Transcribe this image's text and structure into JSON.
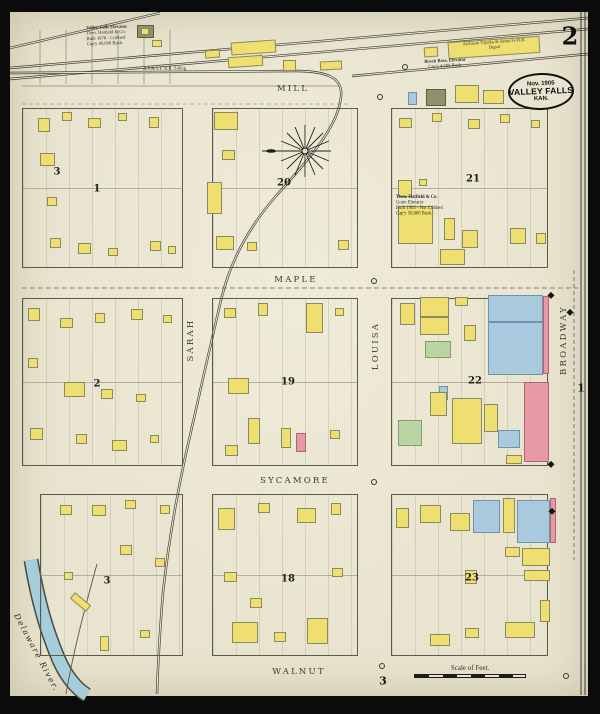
{
  "sheet": {
    "page_number": "2",
    "stamp": {
      "date": "Nov. 1905",
      "city": "VALLEY FALLS",
      "state": "KAN."
    },
    "scale_label": "Scale of Feet."
  },
  "colors": {
    "paper": "#e9e4cf",
    "photo_border": "#0b0b0b",
    "river": "#a5cdda",
    "ink": "#3a3a30",
    "code_map": {
      "f": "frame",
      "b": "brick",
      "s": "stone",
      "g": "special",
      "i": "iron_clad"
    },
    "buildings": {
      "frame": {
        "fill": "#efdf70",
        "stroke": "#8a8a60"
      },
      "brick": {
        "fill": "#e59aa5",
        "stroke": "#b06570"
      },
      "stone": {
        "fill": "#a9cade",
        "stroke": "#6f93ab"
      },
      "special": {
        "fill": "#bad4a4",
        "stroke": "#7fa06b"
      },
      "iron_clad": {
        "fill": "#90906a",
        "stroke": "#5c5c40"
      }
    }
  },
  "streets": [
    {
      "name": "MILL",
      "o": "h",
      "x": 293,
      "y": 89
    },
    {
      "name": "MAPLE",
      "o": "h",
      "x": 296,
      "y": 280
    },
    {
      "name": "SYCAMORE",
      "o": "h",
      "x": 295,
      "y": 481
    },
    {
      "name": "WALNUT",
      "o": "h",
      "x": 299,
      "y": 672
    },
    {
      "name": "SARAH",
      "o": "v",
      "x": 191,
      "y": 340
    },
    {
      "name": "LOUISA",
      "o": "v",
      "x": 376,
      "y": 346
    },
    {
      "name": "BROADWAY",
      "o": "v",
      "x": 564,
      "y": 340
    }
  ],
  "block_labels": [
    {
      "t": "3",
      "x": 57,
      "y": 172
    },
    {
      "t": "1",
      "x": 97,
      "y": 189
    },
    {
      "t": "20",
      "x": 284,
      "y": 183
    },
    {
      "t": "21",
      "x": 473,
      "y": 179
    },
    {
      "t": "2",
      "x": 97,
      "y": 384
    },
    {
      "t": "19",
      "x": 288,
      "y": 382
    },
    {
      "t": "22",
      "x": 475,
      "y": 381
    },
    {
      "t": "3",
      "x": 107,
      "y": 581
    },
    {
      "t": "18",
      "x": 288,
      "y": 579
    },
    {
      "t": "23",
      "x": 472,
      "y": 578
    }
  ],
  "edge_markers": [
    {
      "t": "1",
      "x": 581,
      "y": 388,
      "s": 11
    },
    {
      "t": "3",
      "x": 383,
      "y": 681,
      "s": 11
    }
  ],
  "blocks": [
    [
      22,
      108,
      161,
      160
    ],
    [
      212,
      108,
      146,
      160
    ],
    [
      391,
      108,
      157,
      160
    ],
    [
      22,
      298,
      161,
      168
    ],
    [
      212,
      298,
      146,
      168
    ],
    [
      391,
      298,
      157,
      168
    ],
    [
      40,
      494,
      143,
      162
    ],
    [
      212,
      494,
      146,
      162
    ],
    [
      391,
      494,
      157,
      162
    ]
  ],
  "buildings": [
    [
      137,
      25,
      17,
      13,
      "i",
      0,
      0
    ],
    [
      141,
      28,
      8,
      7,
      "f",
      0,
      0
    ],
    [
      152,
      40,
      10,
      7,
      "f",
      0,
      0
    ],
    [
      205,
      50,
      15,
      8,
      "f",
      0,
      -4
    ],
    [
      231,
      41,
      45,
      13,
      "f",
      0,
      -4
    ],
    [
      228,
      56,
      35,
      11,
      "f",
      0,
      -4
    ],
    [
      283,
      60,
      13,
      11,
      "f",
      0,
      0
    ],
    [
      320,
      61,
      22,
      9,
      "f",
      0,
      -3
    ],
    [
      424,
      47,
      14,
      10,
      "f",
      0,
      -4
    ],
    [
      448,
      39,
      92,
      17,
      "f",
      0,
      -4
    ],
    [
      408,
      92,
      9,
      13,
      "s",
      0,
      0
    ],
    [
      426,
      89,
      20,
      17,
      "i",
      1,
      0
    ],
    [
      455,
      85,
      24,
      18,
      "f",
      1,
      0
    ],
    [
      483,
      90,
      21,
      14,
      "f",
      0,
      0
    ],
    [
      38,
      118,
      12,
      14,
      "f",
      0,
      0
    ],
    [
      62,
      112,
      10,
      9,
      "f",
      0,
      0
    ],
    [
      88,
      118,
      13,
      10,
      "f",
      0,
      0
    ],
    [
      118,
      113,
      9,
      8,
      "f",
      0,
      0
    ],
    [
      149,
      117,
      10,
      11,
      "f",
      0,
      0
    ],
    [
      40,
      153,
      15,
      13,
      "f",
      0,
      0
    ],
    [
      47,
      197,
      10,
      9,
      "f",
      0,
      0
    ],
    [
      50,
      238,
      11,
      10,
      "f",
      0,
      0
    ],
    [
      78,
      243,
      13,
      11,
      "f",
      0,
      0
    ],
    [
      108,
      248,
      10,
      8,
      "f",
      0,
      0
    ],
    [
      150,
      241,
      11,
      10,
      "f",
      0,
      0
    ],
    [
      168,
      246,
      8,
      8,
      "f",
      0,
      0
    ],
    [
      214,
      112,
      24,
      18,
      "f",
      1,
      0
    ],
    [
      222,
      150,
      13,
      10,
      "f",
      0,
      0
    ],
    [
      207,
      182,
      15,
      32,
      "f",
      1,
      0
    ],
    [
      216,
      236,
      18,
      14,
      "f",
      0,
      0
    ],
    [
      247,
      242,
      10,
      9,
      "f",
      0,
      0
    ],
    [
      338,
      240,
      11,
      10,
      "f",
      0,
      0
    ],
    [
      399,
      118,
      13,
      10,
      "f",
      0,
      0
    ],
    [
      432,
      113,
      10,
      9,
      "f",
      0,
      0
    ],
    [
      468,
      119,
      12,
      10,
      "f",
      0,
      0
    ],
    [
      500,
      114,
      10,
      9,
      "f",
      0,
      0
    ],
    [
      531,
      120,
      9,
      8,
      "f",
      0,
      0
    ],
    [
      398,
      180,
      14,
      17,
      "f",
      1,
      0
    ],
    [
      419,
      179,
      8,
      7,
      "f",
      0,
      0
    ],
    [
      398,
      206,
      35,
      38,
      "f",
      1,
      0
    ],
    [
      444,
      218,
      11,
      22,
      "f",
      0,
      0
    ],
    [
      440,
      249,
      25,
      16,
      "f",
      0,
      0
    ],
    [
      462,
      230,
      16,
      18,
      "f",
      0,
      0
    ],
    [
      510,
      228,
      16,
      16,
      "f",
      0,
      0
    ],
    [
      536,
      233,
      10,
      11,
      "f",
      0,
      0
    ],
    [
      28,
      308,
      12,
      13,
      "f",
      0,
      0
    ],
    [
      60,
      318,
      13,
      10,
      "f",
      0,
      0
    ],
    [
      95,
      313,
      10,
      10,
      "f",
      0,
      0
    ],
    [
      131,
      309,
      12,
      11,
      "f",
      0,
      0
    ],
    [
      163,
      315,
      9,
      8,
      "f",
      0,
      0
    ],
    [
      28,
      358,
      10,
      10,
      "f",
      0,
      0
    ],
    [
      64,
      382,
      21,
      15,
      "f",
      1,
      0
    ],
    [
      101,
      389,
      12,
      10,
      "f",
      0,
      0
    ],
    [
      136,
      394,
      10,
      8,
      "f",
      0,
      0
    ],
    [
      30,
      428,
      13,
      12,
      "f",
      0,
      0
    ],
    [
      76,
      434,
      11,
      10,
      "f",
      0,
      0
    ],
    [
      112,
      440,
      15,
      11,
      "f",
      0,
      0
    ],
    [
      150,
      435,
      9,
      8,
      "f",
      0,
      0
    ],
    [
      224,
      308,
      12,
      10,
      "f",
      0,
      0
    ],
    [
      258,
      303,
      10,
      13,
      "f",
      0,
      0
    ],
    [
      306,
      303,
      17,
      30,
      "f",
      0,
      0
    ],
    [
      335,
      308,
      9,
      8,
      "f",
      0,
      0
    ],
    [
      228,
      378,
      21,
      16,
      "f",
      1,
      0
    ],
    [
      248,
      418,
      12,
      26,
      "f",
      0,
      0
    ],
    [
      281,
      428,
      10,
      20,
      "f",
      0,
      0
    ],
    [
      296,
      433,
      10,
      19,
      "b",
      0,
      0
    ],
    [
      225,
      445,
      13,
      11,
      "f",
      0,
      0
    ],
    [
      330,
      430,
      10,
      9,
      "f",
      0,
      0
    ],
    [
      400,
      303,
      15,
      22,
      "f",
      0,
      0
    ],
    [
      420,
      297,
      29,
      20,
      "f",
      1,
      0
    ],
    [
      420,
      317,
      29,
      18,
      "f",
      1,
      0
    ],
    [
      455,
      297,
      13,
      9,
      "f",
      0,
      0
    ],
    [
      488,
      295,
      55,
      27,
      "s",
      0,
      0
    ],
    [
      488,
      322,
      55,
      53,
      "s",
      0,
      0
    ],
    [
      543,
      296,
      6,
      78,
      "b",
      0,
      0
    ],
    [
      464,
      325,
      12,
      16,
      "f",
      0,
      0
    ],
    [
      425,
      341,
      26,
      17,
      "g",
      0,
      0
    ],
    [
      439,
      386,
      9,
      14,
      "s",
      1,
      0
    ],
    [
      430,
      392,
      17,
      24,
      "f",
      0,
      0
    ],
    [
      398,
      420,
      24,
      26,
      "g",
      0,
      0
    ],
    [
      452,
      398,
      30,
      46,
      "f",
      0,
      0
    ],
    [
      484,
      404,
      14,
      28,
      "f",
      0,
      0
    ],
    [
      498,
      430,
      22,
      18,
      "s",
      0,
      0
    ],
    [
      524,
      382,
      25,
      80,
      "b",
      0,
      0
    ],
    [
      506,
      455,
      16,
      9,
      "f",
      0,
      0
    ],
    [
      60,
      505,
      12,
      10,
      "f",
      0,
      0
    ],
    [
      92,
      505,
      14,
      11,
      "f",
      0,
      0
    ],
    [
      125,
      500,
      11,
      9,
      "f",
      0,
      0
    ],
    [
      160,
      505,
      10,
      9,
      "f",
      0,
      0
    ],
    [
      120,
      545,
      12,
      10,
      "f",
      0,
      0
    ],
    [
      155,
      558,
      10,
      9,
      "f",
      0,
      0
    ],
    [
      64,
      572,
      9,
      8,
      "f",
      0,
      0
    ],
    [
      70,
      598,
      21,
      8,
      "f",
      0,
      40
    ],
    [
      100,
      636,
      9,
      15,
      "f",
      0,
      0
    ],
    [
      140,
      630,
      10,
      8,
      "f",
      0,
      0
    ],
    [
      218,
      508,
      17,
      22,
      "f",
      0,
      0
    ],
    [
      258,
      503,
      12,
      10,
      "f",
      0,
      0
    ],
    [
      297,
      508,
      19,
      15,
      "f",
      0,
      0
    ],
    [
      331,
      503,
      10,
      12,
      "f",
      0,
      0
    ],
    [
      224,
      572,
      13,
      10,
      "f",
      0,
      0
    ],
    [
      250,
      598,
      12,
      10,
      "f",
      0,
      0
    ],
    [
      232,
      622,
      26,
      21,
      "f",
      0,
      0
    ],
    [
      307,
      618,
      21,
      26,
      "f",
      0,
      0
    ],
    [
      332,
      568,
      11,
      9,
      "f",
      0,
      0
    ],
    [
      274,
      632,
      12,
      10,
      "f",
      0,
      0
    ],
    [
      396,
      508,
      13,
      20,
      "f",
      0,
      0
    ],
    [
      420,
      505,
      21,
      18,
      "f",
      0,
      0
    ],
    [
      450,
      513,
      20,
      18,
      "f",
      0,
      0
    ],
    [
      473,
      500,
      27,
      33,
      "s",
      0,
      0
    ],
    [
      503,
      498,
      12,
      35,
      "f",
      0,
      0
    ],
    [
      517,
      500,
      33,
      43,
      "s",
      0,
      0
    ],
    [
      550,
      498,
      6,
      45,
      "b",
      0,
      0
    ],
    [
      505,
      547,
      15,
      10,
      "f",
      0,
      0
    ],
    [
      522,
      548,
      28,
      18,
      "f",
      0,
      0
    ],
    [
      524,
      570,
      26,
      11,
      "f",
      0,
      0
    ],
    [
      465,
      570,
      12,
      14,
      "f",
      0,
      0
    ],
    [
      430,
      634,
      20,
      12,
      "f",
      0,
      0
    ],
    [
      465,
      628,
      14,
      10,
      "f",
      0,
      0
    ],
    [
      505,
      622,
      30,
      16,
      "f",
      0,
      0
    ],
    [
      540,
      600,
      10,
      22,
      "f",
      0,
      0
    ]
  ],
  "annotations": [
    {
      "name": "valley-falls-elevator-note",
      "x": 86,
      "y": 25,
      "w": 76,
      "rot": -2,
      "b": 1,
      "align": "left",
      "lines": [
        "Valley Falls Elevator",
        "Theo. Hatfield & Co.",
        "Built 1878 - Cribbed",
        "Cap'y 40,000 Bush."
      ]
    },
    {
      "name": "brock-bros-elevator-note",
      "x": 402,
      "y": 60,
      "w": 86,
      "rot": -3,
      "b": 1,
      "align": "center",
      "lines": [
        "Brock Bros. Elevator",
        "Cap'y 4,000 Bush."
      ]
    },
    {
      "name": "depot-label",
      "x": 452,
      "y": 42,
      "w": 84,
      "rot": -4,
      "b": 0,
      "align": "center",
      "lines": [
        "Atchison Topeka & Santa Fe R.R.",
        "Depot"
      ]
    },
    {
      "name": "hatfield-grain-elevator-note",
      "x": 396,
      "y": 194,
      "w": 84,
      "rot": 0,
      "b": 1,
      "align": "left",
      "lines": [
        "Theo. Hatfield & Co.",
        "Grain Elevator",
        "Built 1903 - Not Cribbed",
        "Cap'y 30,000 Bush."
      ]
    },
    {
      "name": "rr-siding-label",
      "x": 143,
      "y": 66,
      "w": 90,
      "rot": -1,
      "b": 0,
      "align": "left",
      "lines": [
        "A.T.& S.F. R.R. Siding"
      ]
    },
    {
      "name": "river-label",
      "x": 20,
      "y": 612,
      "w": 70,
      "rot": 62,
      "b": 0,
      "it": 1,
      "sc": 1,
      "align": "left",
      "lines": [
        "Delaware  River."
      ]
    }
  ],
  "symbols": [
    [
      405,
      67
    ],
    [
      380,
      97
    ],
    [
      374,
      281
    ],
    [
      374,
      482
    ],
    [
      382,
      666
    ],
    [
      566,
      676
    ]
  ],
  "dots": [
    [
      551,
      295
    ],
    [
      551,
      464
    ],
    [
      552,
      511
    ],
    [
      570,
      312
    ]
  ]
}
